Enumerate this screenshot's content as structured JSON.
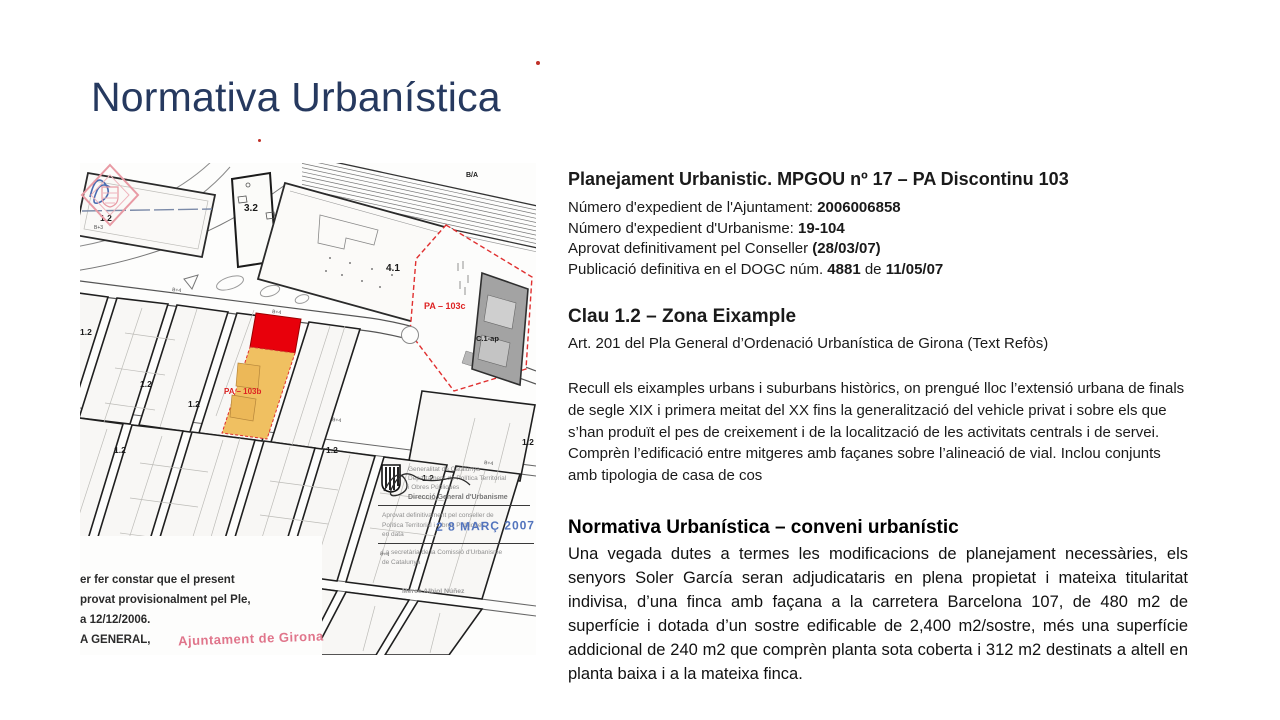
{
  "slide": {
    "title": "Normativa Urbanística"
  },
  "planejament": {
    "heading": "Planejament Urbanistic. MPGOU nº 17 – PA Discontinu 103",
    "details": [
      [
        {
          "text": "Número d'expedient de l'Ajuntament: "
        },
        {
          "text": "2006006858",
          "bold": true
        }
      ],
      [
        {
          "text": "Número d'expedient d'Urbanisme: "
        },
        {
          "text": "19-104",
          "bold": true
        }
      ],
      [
        {
          "text": "Aprovat definitivament pel Conseller "
        },
        {
          "text": "(28/03/07)",
          "bold": true
        }
      ],
      [
        {
          "text": "Publicació definitiva en el DOGC núm. "
        },
        {
          "text": "4881",
          "bold": true
        },
        {
          "text": " de "
        },
        {
          "text": "11/05/07",
          "bold": true
        }
      ]
    ]
  },
  "clau": {
    "heading": "Clau 1.2 – Zona Eixample",
    "subheading": "Art. 201 del Pla General d’Ordenació Urbanística de Girona (Text Refòs)",
    "paragraph": "Recull els eixamples urbans i suburbans històrics, on prengué lloc l’extensió urbana de finals de segle XIX i primera meitat del XX fins la generalització del vehicle privat i sobre els que s’han produït el pes de creixement i de la localització de les activitats centrals i de servei. Comprèn l’edificació entre mitgeres amb façanes sobre l’alineació de vial. Inclou conjunts amb tipologia de casa de cos"
  },
  "conveni": {
    "heading": "Normativa Urbanística – conveni urbanístic",
    "paragraph": "Una vegada dutes a termes les modificacions de planejament necessàries, els senyors Soler García seran adjudicataris en plena propietat i mateixa titularitat indivisa, d’una finca amb façana a la carretera Barcelona 107, de 480 m2 de superfície i dotada d’un sostre edificable de 2,400 m2/sostre, més una superfície addicional de 240 m2 que comprèn planta sota coberta i 312 m2 destinats a altell en planta baixa i a la mateixa finca."
  },
  "map": {
    "labels": {
      "ba": "B/A",
      "z32": "3.2",
      "z41": "4.1",
      "z12": "1.2",
      "z14": "1.4",
      "zc1": "C.1",
      "bplus4": "B+4",
      "bplus3": "B+3",
      "pa103b": "PA – 103b",
      "pa103c": "PA – 103c",
      "c1ap": "C.1-ap"
    },
    "colors": {
      "parcel_red": "#e8000b",
      "parcel_orange": "#f0c061",
      "boundary_red": "#e03030",
      "building_gray": "#a3a3a3"
    },
    "note": {
      "lines": [
        "er fer constar que el present",
        "provat provisionalment pel Ple,",
        "a 12/12/2006.",
        "A GENERAL,"
      ],
      "stamp_text": "Ajuntament de Girona"
    },
    "stamp": {
      "org_lines": [
        "Generalitat de Catalunya",
        "Departament de Política Territorial",
        "i Obres Públiques"
      ],
      "dept": "Direcció General d'Urbanisme",
      "approval_lines": [
        "Aprovat definitivament pel conseller de",
        "Política Territorial i Obres Públiques",
        "en data"
      ],
      "date": "2 8 MARÇ 2007",
      "secretary_lines": [
        "La secretària de la Comissió d'Urbanisme",
        "de Catalunya"
      ],
      "name": "Mercè Albiol Núñez"
    }
  }
}
